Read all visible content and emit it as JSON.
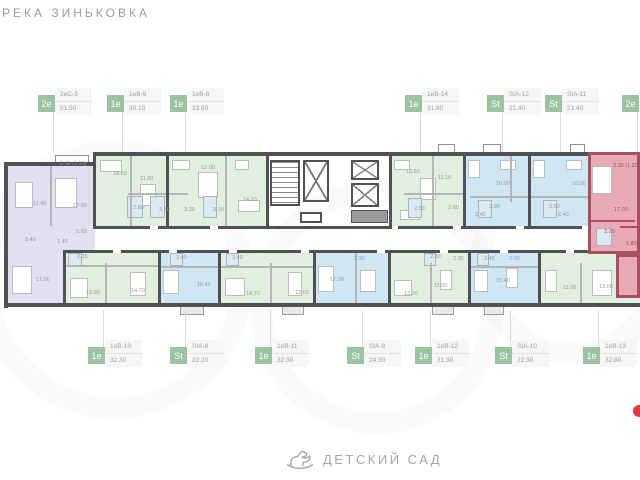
{
  "header": {
    "river_label": "РЕКА ЗИНЬКОВКА"
  },
  "footer": {
    "kindergarten_label": "ДЕТСКИЙ САД",
    "icon": "rocking-horse-icon"
  },
  "edge_marker": {
    "color": "#e5383f"
  },
  "colors": {
    "wall": "#515155",
    "badge": "#9cc2a1",
    "green": "#e1efdf",
    "blue": "#cfe6f5",
    "lavender": "#e0e0f1",
    "pink": "#eaa9b6",
    "pink_wall": "#a8505f",
    "room_label": "#98989b",
    "pink_label": "#9c4f5e"
  },
  "units_top": [
    {
      "type": "2е",
      "name": "2еС-3",
      "area": "51.50",
      "x": 38
    },
    {
      "type": "1е",
      "name": "1еВ-9",
      "area": "30.10",
      "x": 107
    },
    {
      "type": "1е",
      "name": "1еВ-8",
      "area": "33.60",
      "x": 170
    },
    {
      "type": "1е",
      "name": "1еВ-14",
      "area": "31.80",
      "x": 405
    },
    {
      "type": "St",
      "name": "StA-12",
      "area": "21.40",
      "x": 487
    },
    {
      "type": "St",
      "name": "StA-11",
      "area": "21.40",
      "x": 545
    },
    {
      "type": "2е",
      "name": "",
      "area": "",
      "x": 622
    }
  ],
  "units_bottom": [
    {
      "type": "1е",
      "name": "1еВ-10",
      "area": "32.30",
      "x": 88
    },
    {
      "type": "St",
      "name": "StA-8",
      "area": "22.20",
      "x": 170
    },
    {
      "type": "1е",
      "name": "1еВ-11",
      "area": "32.30",
      "x": 255
    },
    {
      "type": "St",
      "name": "StA-9",
      "area": "24.30",
      "x": 347
    },
    {
      "type": "1е",
      "name": "1еВ-12",
      "area": "31.30",
      "x": 415
    },
    {
      "type": "St",
      "name": "StA-10",
      "area": "22.30",
      "x": 495
    },
    {
      "type": "1е",
      "name": "1еВ-13",
      "area": "32.80",
      "x": 583
    }
  ],
  "plan": {
    "rooms": [
      {
        "x": 60,
        "y": 161,
        "t": "2.30 (1.20)"
      },
      {
        "x": 33,
        "y": 201,
        "t": "11.40"
      },
      {
        "x": 73,
        "y": 203,
        "t": "17.00"
      },
      {
        "x": 76,
        "y": 229,
        "t": "5.50"
      },
      {
        "x": 25,
        "y": 237,
        "t": "3.40"
      },
      {
        "x": 57,
        "y": 239,
        "t": "1.40"
      },
      {
        "x": 113,
        "y": 171,
        "t": "14.60"
      },
      {
        "x": 140,
        "y": 176,
        "t": "11.00"
      },
      {
        "x": 133,
        "y": 205,
        "t": "2.80"
      },
      {
        "x": 159,
        "y": 207,
        "t": "3.30"
      },
      {
        "x": 184,
        "y": 207,
        "t": "3.30"
      },
      {
        "x": 201,
        "y": 165,
        "t": "12.00"
      },
      {
        "x": 213,
        "y": 207,
        "t": "3.10"
      },
      {
        "x": 243,
        "y": 197,
        "t": "14.20"
      },
      {
        "x": 406,
        "y": 169,
        "t": "13.60"
      },
      {
        "x": 438,
        "y": 175,
        "t": "11.10"
      },
      {
        "x": 414,
        "y": 206,
        "t": "2.80"
      },
      {
        "x": 448,
        "y": 205,
        "t": "2.60"
      },
      {
        "x": 496,
        "y": 181,
        "t": "16.00"
      },
      {
        "x": 489,
        "y": 204,
        "t": "3.00"
      },
      {
        "x": 475,
        "y": 212,
        "t": "2.40"
      },
      {
        "x": 572,
        "y": 181,
        "t": "16.00"
      },
      {
        "x": 549,
        "y": 204,
        "t": "3.00"
      },
      {
        "x": 558,
        "y": 212,
        "t": "2.40"
      },
      {
        "x": 613,
        "y": 163,
        "t": "2.30 (1.20)",
        "p": 1
      },
      {
        "x": 614,
        "y": 207,
        "t": "17.00",
        "p": 1
      },
      {
        "x": 604,
        "y": 229,
        "t": "3.20",
        "p": 1
      },
      {
        "x": 626,
        "y": 241,
        "t": "1.80",
        "p": 1
      },
      {
        "x": 36,
        "y": 277,
        "t": "17.00"
      },
      {
        "x": 86,
        "y": 290,
        "t": "12.00"
      },
      {
        "x": 131,
        "y": 288,
        "t": "14.70"
      },
      {
        "x": 77,
        "y": 254,
        "t": "2.35"
      },
      {
        "x": 197,
        "y": 282,
        "t": "16.40"
      },
      {
        "x": 176,
        "y": 255,
        "t": "3.40"
      },
      {
        "x": 246,
        "y": 291,
        "t": "14.70"
      },
      {
        "x": 295,
        "y": 290,
        "t": "12.00"
      },
      {
        "x": 232,
        "y": 255,
        "t": "3.40"
      },
      {
        "x": 330,
        "y": 277,
        "t": "17.00"
      },
      {
        "x": 354,
        "y": 256,
        "t": "3.30"
      },
      {
        "x": 404,
        "y": 291,
        "t": "13.20"
      },
      {
        "x": 434,
        "y": 283,
        "t": "11.00"
      },
      {
        "x": 430,
        "y": 254,
        "t": "2.80"
      },
      {
        "x": 453,
        "y": 256,
        "t": "2.30"
      },
      {
        "x": 496,
        "y": 278,
        "t": "15.40"
      },
      {
        "x": 484,
        "y": 256,
        "t": "3.40"
      },
      {
        "x": 509,
        "y": 256,
        "t": "3.00"
      },
      {
        "x": 563,
        "y": 285,
        "t": "11.00"
      },
      {
        "x": 599,
        "y": 284,
        "t": "13.00"
      }
    ]
  }
}
